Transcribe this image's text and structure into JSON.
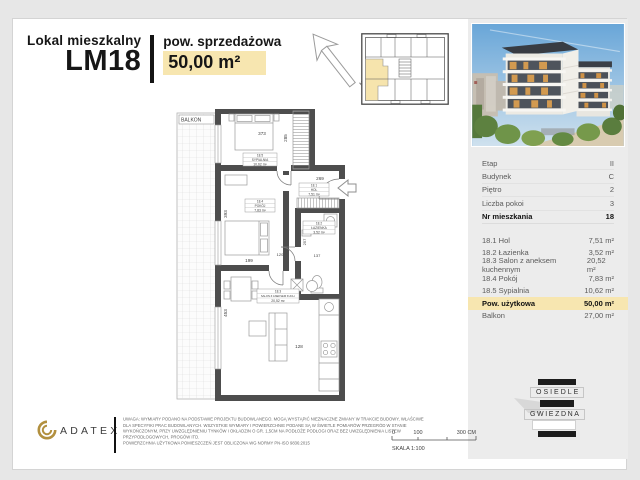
{
  "header": {
    "type_label": "Lokal mieszkalny",
    "unit_id": "LM18",
    "area_label": "pow. sprzedażowa",
    "area_value": "50,00 m²"
  },
  "plan": {
    "balcony_label": "BALKON",
    "north_label": "N",
    "dims": {
      "bedroom_w": "373",
      "bedroom_h": "285",
      "hall_w": "269",
      "pokoj_h": "393",
      "pokoj_w": "199",
      "corridor": "120",
      "bath_h": "257",
      "bath_w": "137",
      "salon_h": "453",
      "salon_w": "128"
    },
    "rooms": {
      "sypialnia": {
        "no": "18.5",
        "name": "SYPIALNIA",
        "area": "10,62 m²"
      },
      "hol": {
        "no": "18.1",
        "name": "HOL",
        "area": "7,51 m²"
      },
      "pokoj": {
        "no": "18.4",
        "name": "POKÓJ",
        "area": "7,83 m²"
      },
      "lazienka": {
        "no": "18.2",
        "name": "ŁAZIENKA",
        "area": "3,52 m²"
      },
      "salon": {
        "no": "18.3",
        "name": "SALON Z ANEKSEM KUCH.",
        "area": "20,52 m²"
      }
    }
  },
  "sidebar": {
    "info_rows": [
      {
        "label": "Etap",
        "value": "II"
      },
      {
        "label": "Budynek",
        "value": "C"
      },
      {
        "label": "Piętro",
        "value": "2"
      },
      {
        "label": "Liczba pokoi",
        "value": "3"
      },
      {
        "label": "Nr mieszkania",
        "value": "18"
      }
    ],
    "room_rows": [
      {
        "label": "18.1 Hol",
        "value": "7,51 m²"
      },
      {
        "label": "18.2 Łazienka",
        "value": "3,52 m²"
      },
      {
        "label": "18.3 Salon z aneksem kuchennym",
        "value": "20,52 m²"
      },
      {
        "label": "18.4 Pokój",
        "value": "7,83 m²"
      },
      {
        "label": "18.5 Sypialnia",
        "value": "10,62 m²"
      }
    ],
    "total_row": {
      "label": "Pow. użytkowa",
      "value": "50,00 m²"
    },
    "balcony_row": {
      "label": "Balkon",
      "value": "27,00 m²"
    },
    "estate_logo": {
      "line1": "OSIEDLE",
      "line2": "GWIEZDNA"
    }
  },
  "footer": {
    "brand": "ADATEX",
    "disclaimer_lines": [
      "UWAGA: WYMIARY PODANO NA PODSTAWIE PROJEKTU BUDOWLANEGO. MOGĄ WYSTĄPIĆ NIEZNACZNE ZMIANY W TRAKCIE BUDOWY, WŁAŚCIWE",
      "DLA SPECYFIKI PRAC BUDOWLANYCH. WSZYSTKIE WYMIARY I POWIERZCHNIE PODANE SĄ W ŚWIETLE POMIARÓW PRZEGRÓD W STANIE",
      "WYKOŃCZONYM, PRZY UWZGLĘDNIENIU TYNKÓW I OKŁADZIN O GR. 1,5CM NA PODŁOŻE PODŁOGI ORAZ BEZ UWZGLĘDNIENIA LISTEW",
      "PRZYPODŁOGOWYCH, PROGÓW ITD.",
      "POWIERZCHNIA UŻYTKOWA POMIESZCZEŃ JEST OBLICZONA WG NORMY PN-ISO 9836:2015"
    ]
  },
  "scale_bar": {
    "start": "0",
    "mid": "100",
    "end": "300 CM",
    "caption": "SKALA 1:100"
  },
  "colors": {
    "accent_yellow": "#f7e6b0",
    "wall_gray": "#4d4d4d",
    "gold": "#b2903f"
  }
}
